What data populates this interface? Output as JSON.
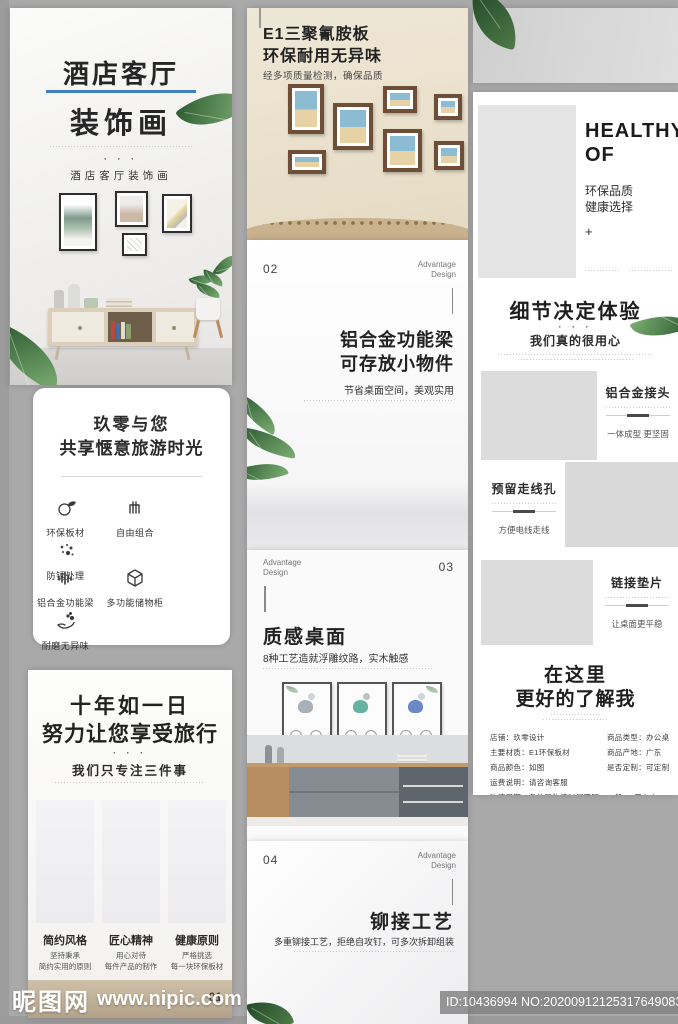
{
  "watermark": {
    "site": "昵图网",
    "url": "www.nipic.com",
    "id_no": "ID:10436994 NO:20200912125317649083"
  },
  "colors": {
    "accent_blue": "#4180c0",
    "frame_brown": "#6f4e37",
    "leaf_green": "#4a7c43"
  },
  "col1": {
    "hero": {
      "title1": "酒店客厅",
      "title2": "装饰画",
      "dots": "· · ·",
      "tagline": "酒店客厅装饰画"
    },
    "card": {
      "title1": "玖零与您",
      "title2": "共享惬意旅游时光",
      "items": [
        {
          "icon": "eco-board-icon",
          "label": "环保板材"
        },
        {
          "icon": "free-combo-icon",
          "label": "自由组合"
        },
        {
          "icon": "antirust-icon",
          "label": "防锈处理"
        },
        {
          "icon": "beam-icon",
          "label": "铝合金功能梁"
        },
        {
          "icon": "storage-icon",
          "label": "多功能储物柜"
        },
        {
          "icon": "wearproof-icon",
          "label": "耐磨无异味"
        }
      ]
    },
    "promise": {
      "title1": "十年如一日",
      "title2": "努力让您享受旅行",
      "dots": "· · ·",
      "subtitle": "我们只专注三件事",
      "items": [
        {
          "title": "简约风格",
          "desc1": "坚持秉承",
          "desc2": "简约实用的原则"
        },
        {
          "title": "匠心精神",
          "desc1": "用心对待",
          "desc2": "每件产品的制作"
        },
        {
          "title": "健康原则",
          "desc1": "严格挑选",
          "desc2": "每一块环保板材"
        }
      ],
      "page_no": "01"
    }
  },
  "col2": {
    "photowall": {
      "title1": "E1三聚氰胺板",
      "title2": "环保耐用无异味",
      "subtitle": "经多项质量检测，确保品质"
    },
    "s02": {
      "num": "02",
      "tag1": "Advantage",
      "tag2": "Design",
      "title1": "铝合金功能梁",
      "title2": "可存放小物件",
      "subtitle": "节省桌面空间，美观实用"
    },
    "s03": {
      "num": "03",
      "tag1": "Advantage",
      "tag2": "Design",
      "title": "质感桌面",
      "subtitle": "8种工艺造就浮雕纹路，实木触感"
    },
    "s04": {
      "num": "04",
      "tag1": "Advantage",
      "tag2": "Design",
      "title": "铆接工艺",
      "subtitle": "多重铆接工艺，拒绝自攻钉，可多次拆卸组装"
    }
  },
  "col3": {
    "healthy": {
      "title1": "HEALTHY",
      "title2": "OF",
      "sub1": "环保品质",
      "sub2": "健康选择",
      "plus": "+"
    },
    "details": {
      "title": "细节决定体验",
      "dots": "· · ·",
      "subtitle": "我们真的很用心",
      "rows": [
        {
          "title": "铝合金接头",
          "desc": "一体成型 更坚固"
        },
        {
          "title": "预留走线孔",
          "desc": "方便电线走线"
        },
        {
          "title": "链接垫片",
          "desc": "让桌面更平稳"
        }
      ]
    },
    "about": {
      "title1": "在这里",
      "title2": "更好的了解我",
      "info_left": [
        {
          "label": "店铺：",
          "value": "玖零设计"
        },
        {
          "label": "主要材质：",
          "value": "E1环保板材"
        },
        {
          "label": "商品颜色：",
          "value": "如图"
        },
        {
          "label": "运费说明：",
          "value": "请咨询客服"
        },
        {
          "label": "物流周期：",
          "value": "各地区物流时间不同，一般3-7天左右"
        }
      ],
      "info_right": [
        {
          "label": "商品类型：",
          "value": "办公桌"
        },
        {
          "label": "商品产地：",
          "value": "广东"
        },
        {
          "label": "是否定制：",
          "value": "可定制"
        }
      ]
    }
  }
}
